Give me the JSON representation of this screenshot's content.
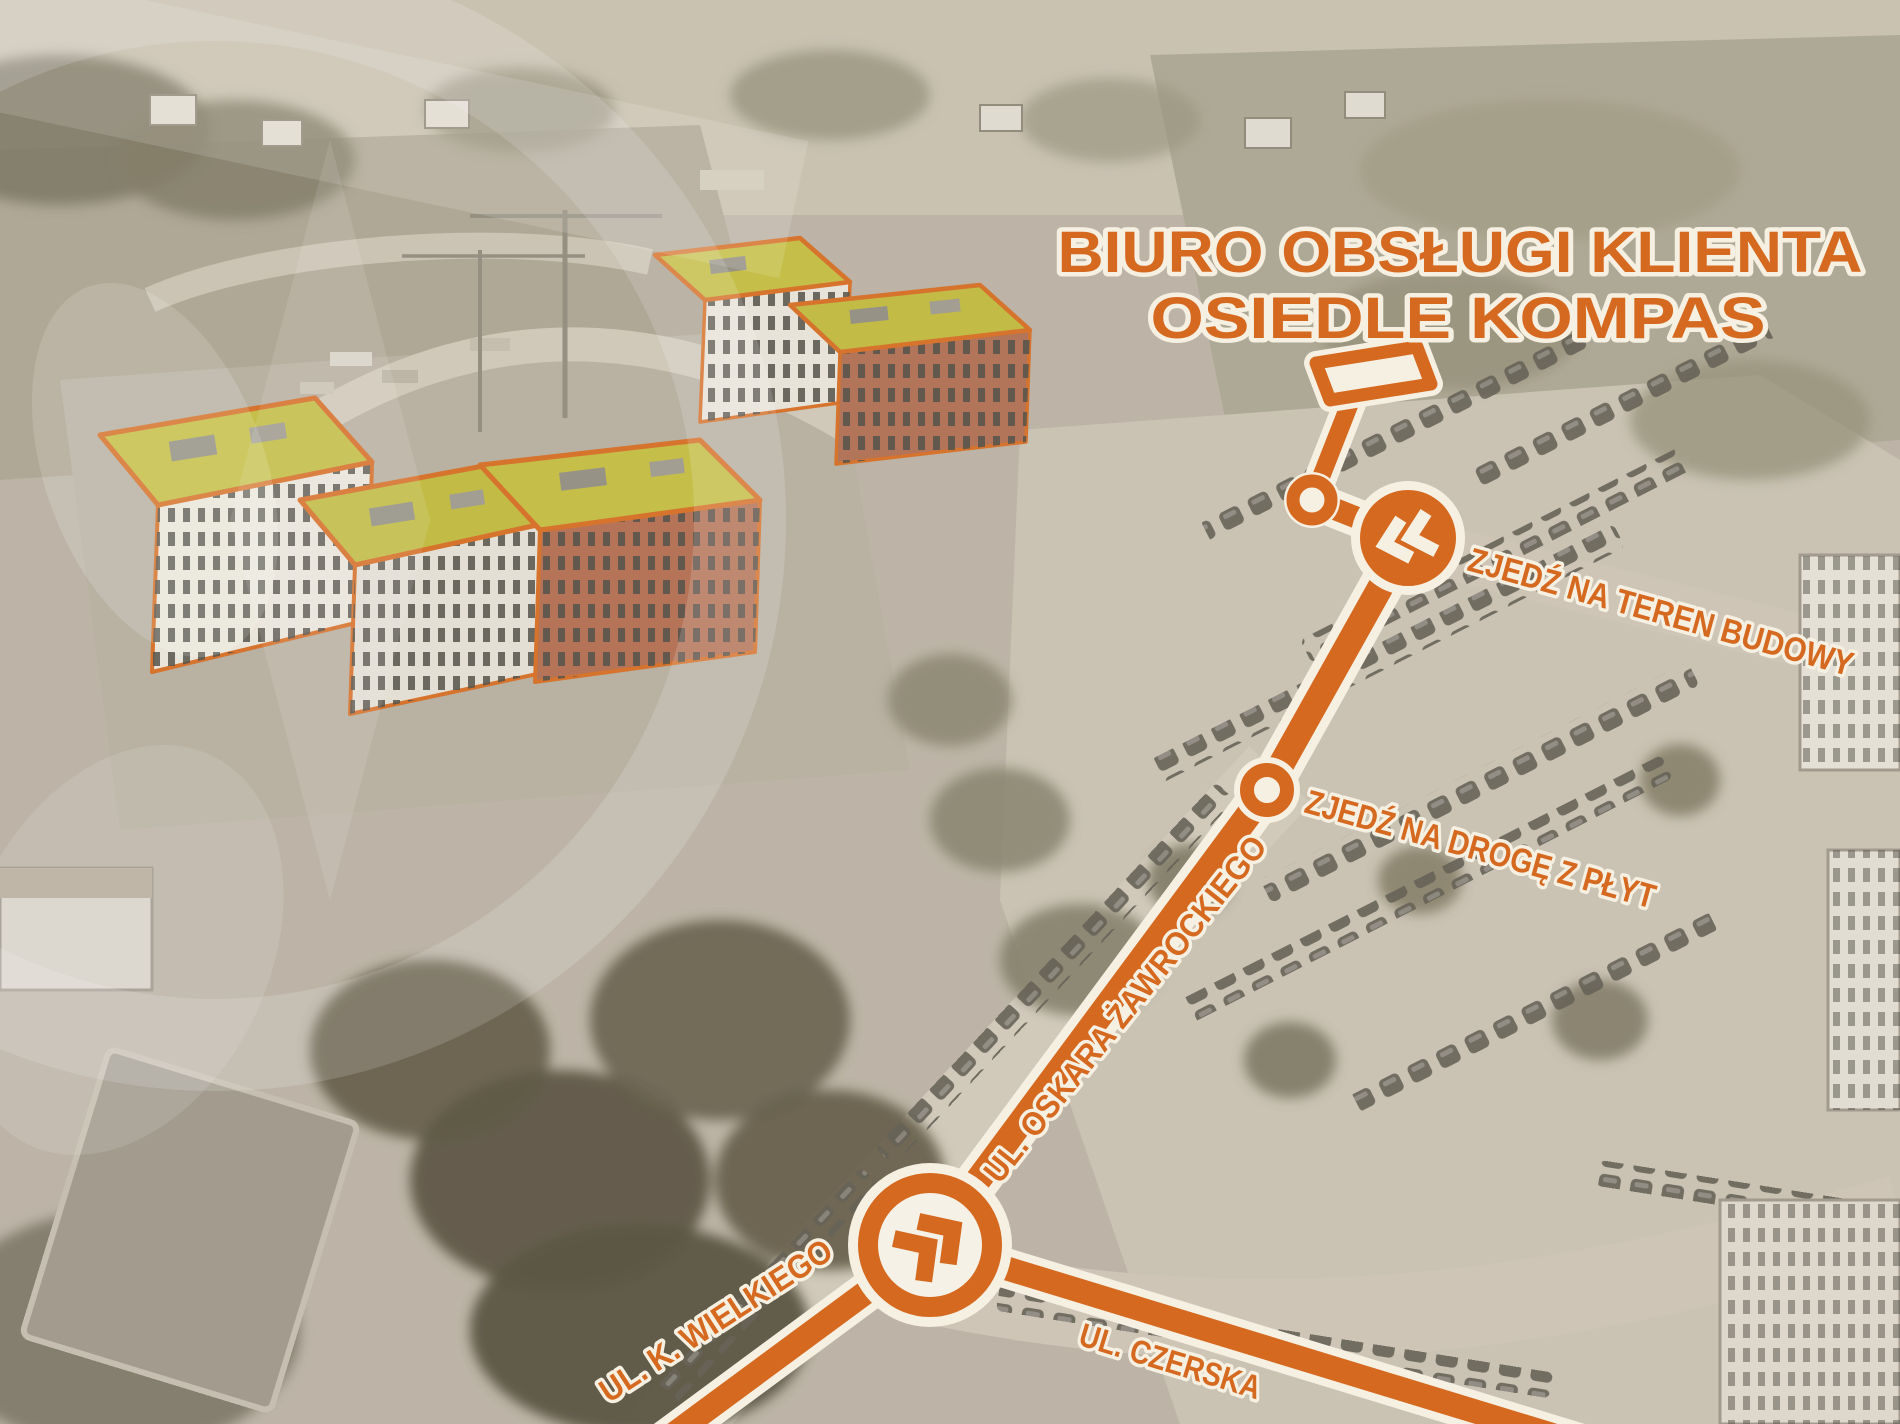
{
  "title": {
    "line1": "BIURO OBSŁUGI KLIENTA",
    "line2": "OSIEDLE KOMPAS"
  },
  "labels": {
    "instruction_teren": "ZJEDŹ NA TEREN BUDOWY",
    "instruction_plyty": "ZJEDŹ NA DROGĘ Z PŁYT",
    "street_zawrockiego": "UL. OSKARA ŻAWROCKIEGO",
    "street_wielkiego": "UL. K. WIELKIEGO",
    "street_czerska": "UL. CZERSKA"
  },
  "colors": {
    "accent_orange": "#D5691F",
    "outline_cream": "#F6F0E3",
    "roof_green": "#C2BD3E",
    "photo_base": "#B9B2A6"
  },
  "icons": {
    "billboard_marker": "billboard-marker-icon",
    "site_entry_chevrons": "chevrons-left-icon",
    "junction_chevrons": "chevrons-right-icon",
    "route_node": "route-node-dot"
  }
}
